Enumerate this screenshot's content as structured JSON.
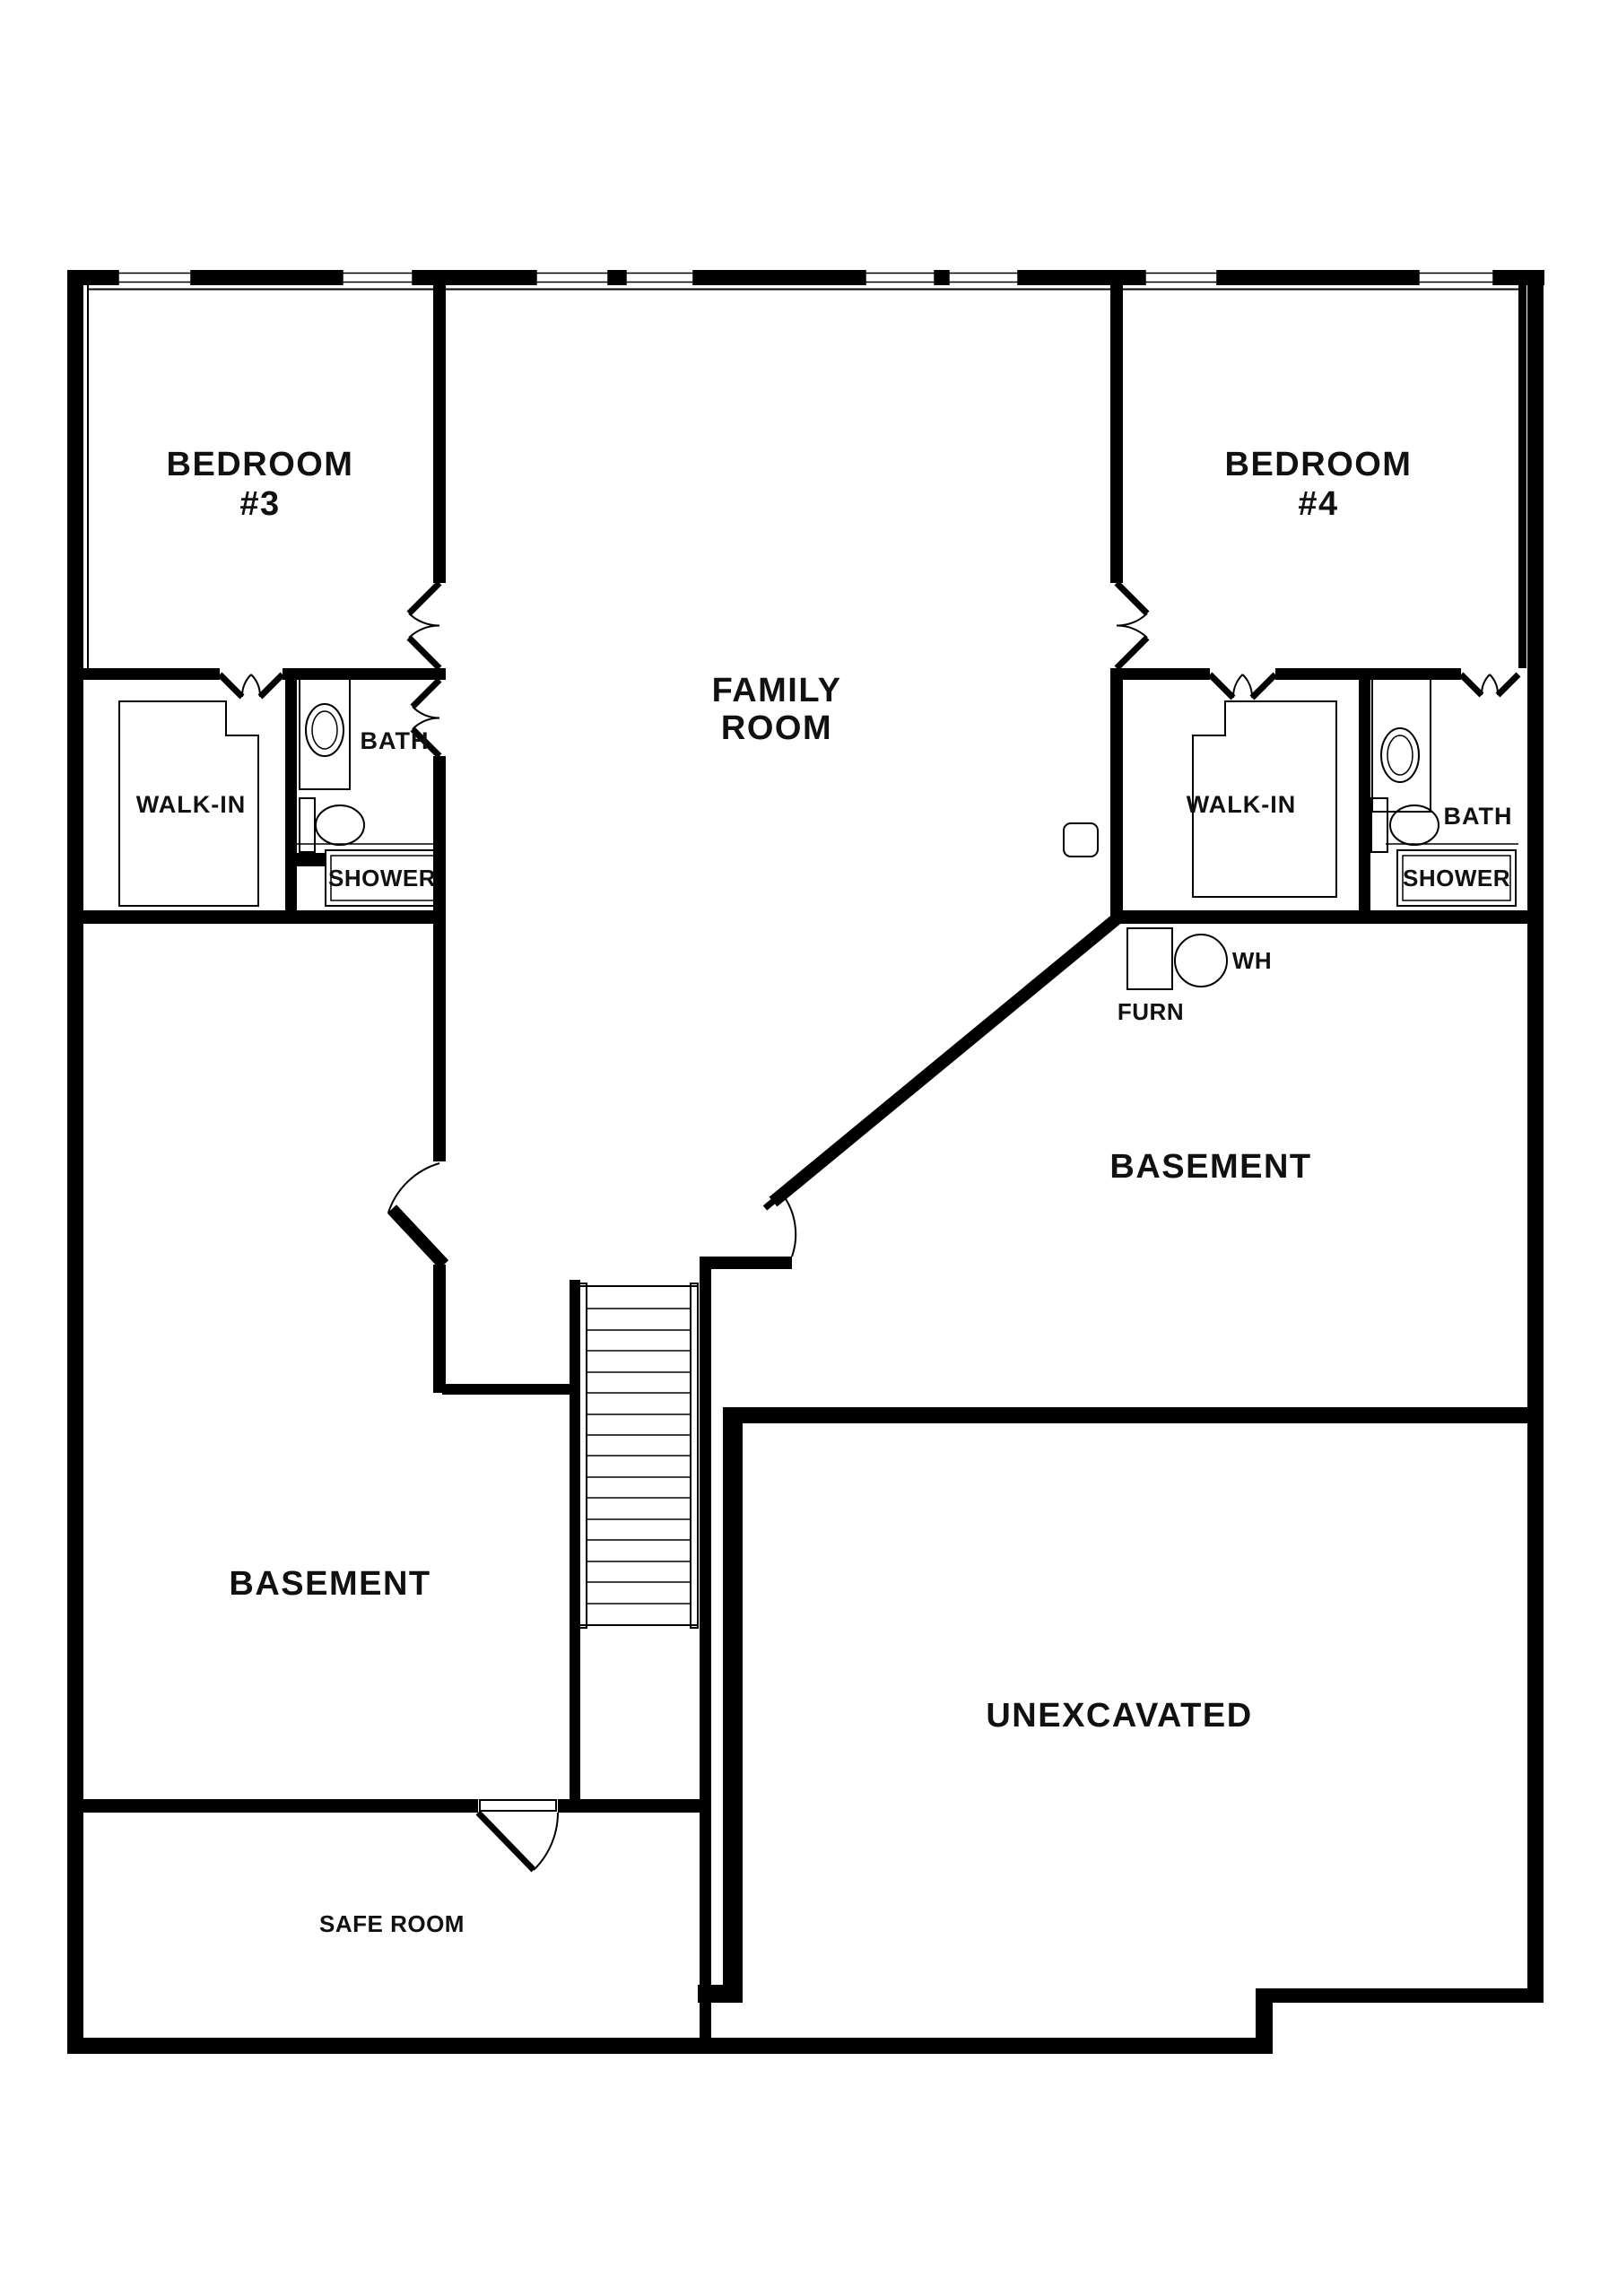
{
  "colors": {
    "wall": "#000000",
    "background": "#ffffff",
    "text": "#111111"
  },
  "rooms": {
    "bedroom3": {
      "line1": "BEDROOM",
      "line2": "#3"
    },
    "bedroom4": {
      "line1": "BEDROOM",
      "line2": "#4"
    },
    "family_room": {
      "line1": "FAMILY",
      "line2": "ROOM"
    },
    "walk_in_left": "WALK-IN",
    "walk_in_right": "WALK-IN",
    "bath_left": "BATH",
    "bath_right": "BATH",
    "shower_left": "SHOWER",
    "shower_right": "SHOWER",
    "basement_left": "BASEMENT",
    "basement_right": "BASEMENT",
    "unexcavated": "UNEXCAVATED",
    "safe_room": "SAFE ROOM",
    "furnace": "FURN",
    "water_heater": "WH"
  }
}
